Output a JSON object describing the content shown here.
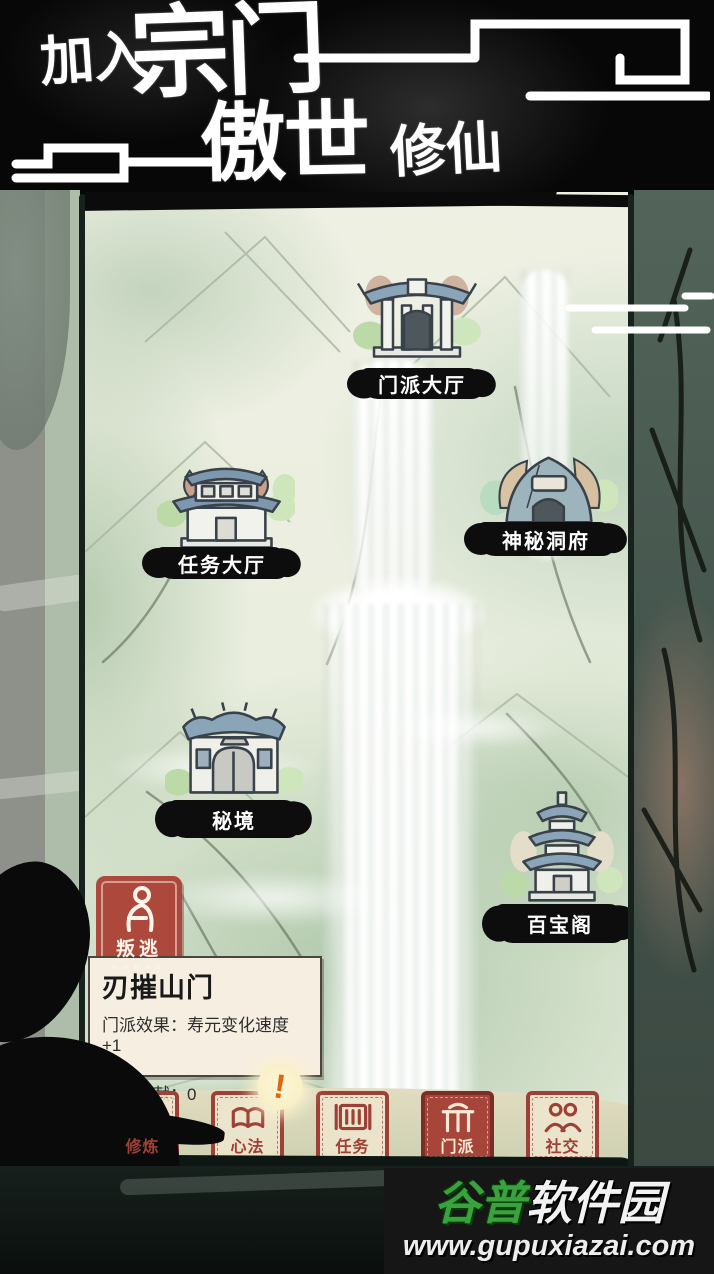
{
  "header": {
    "title_part1": "加入",
    "title_part2": "宗门",
    "title_part3": "傲世",
    "title_part4": "修仙"
  },
  "map": {
    "locations": [
      {
        "id": "sect-hall",
        "label": "门派大厅",
        "icon": "gate-hall-building-icon"
      },
      {
        "id": "mission-hall",
        "label": "任务大厅",
        "icon": "two-story-hall-building-icon"
      },
      {
        "id": "mystery-cave",
        "label": "神秘洞府",
        "icon": "cave-mound-icon"
      },
      {
        "id": "secret-realm",
        "label": "秘境",
        "icon": "round-gate-building-icon"
      },
      {
        "id": "treasure-pavilion",
        "label": "百宝阁",
        "icon": "pagoda-tower-icon"
      }
    ],
    "defect_button": {
      "label": "叛逃",
      "icon": "kneeling-person-icon"
    }
  },
  "sect_panel": {
    "name": "刃摧山门",
    "effect_line": "门派效果：寿元变化速度+1",
    "contribution_line": "门派贡献：0"
  },
  "bottom_nav": {
    "items": [
      {
        "label": "修炼",
        "icon": "mountain-icon",
        "active": false,
        "badge": ""
      },
      {
        "label": "心法",
        "icon": "open-book-icon",
        "active": false,
        "badge": "!"
      },
      {
        "label": "任务",
        "icon": "scroll-icon",
        "active": false,
        "badge": ""
      },
      {
        "label": "门派",
        "icon": "sect-gate-icon",
        "active": true,
        "badge": ""
      },
      {
        "label": "社交",
        "icon": "two-people-icon",
        "active": false,
        "badge": ""
      }
    ]
  },
  "watermark": {
    "site_name_green": "谷普",
    "site_name_white": "软件园",
    "url": "www.gupuxiazai.com"
  },
  "colors": {
    "seal_red": "#a8453a",
    "label_ink": "#0d0d0d",
    "accent_green": "#3aa23c",
    "map_border": "#18221d"
  }
}
